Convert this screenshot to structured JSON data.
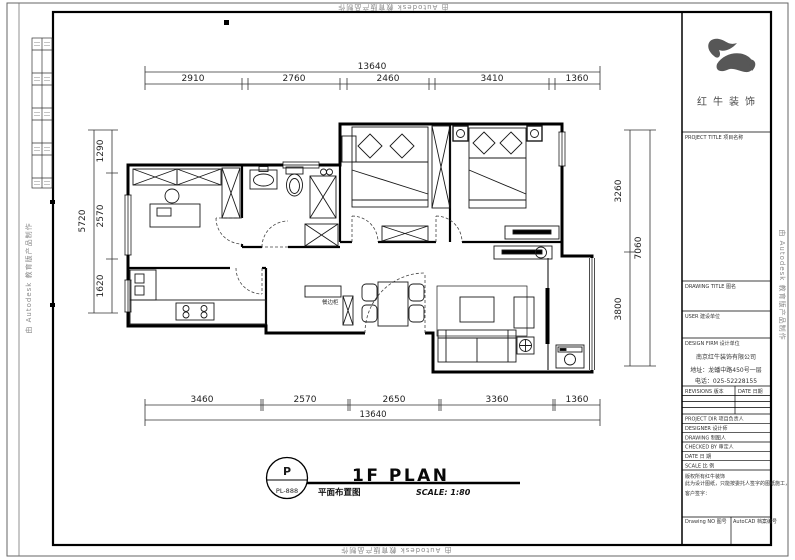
{
  "watermark": "由 Autodesk 教育版产品制作",
  "brand": {
    "name_cn": "红牛装饰"
  },
  "title_block": {
    "project_title": "PROJECT TITLE 项目名称",
    "drawing_title": "DRAWING TITLE 图名",
    "user": "USER 建设单位",
    "design_firm": "DESIGN FIRM 设计单位",
    "company_name": "南京红牛装饰有限公司",
    "address": "地址：龙蟠中路450号一层",
    "phone": "电话：025-52228155",
    "revisions": "REVISIONS 版本",
    "date_col": "DATE 日期",
    "row_labels": [
      "PROJECT DIR 项目负责人",
      "DESIGNER 设计师",
      "DRAWING 制图人",
      "CHECKED BY 审定人",
      "DATE 日 期",
      "SCALE 比 例"
    ],
    "note_line1": "版权所有红牛装饰",
    "note_line2": "此为设计图纸，只能按委托人签字的图纸施工，",
    "client_sign": "客户签字：",
    "drawing_no": "Drawing NO 图号",
    "file_no": "AutoCAD 档案编号"
  },
  "plan": {
    "sheet_mark_top": "P",
    "sheet_mark_bottom": "PL-888",
    "title_en": "1F PLAN",
    "title_cn": "平面布置图",
    "scale": "SCALE: 1:80",
    "furniture_label": "餐边柜",
    "dims": {
      "top_total": "13640",
      "top": [
        "2910",
        "2760",
        "2460",
        "3410",
        "1360"
      ],
      "bottom": [
        "3460",
        "2570",
        "2650",
        "3360",
        "1360"
      ],
      "bottom_total": "13640",
      "left": [
        "1290",
        "2570",
        "1620"
      ],
      "left_total": "5720",
      "right": [
        "3260",
        "3800"
      ],
      "right_total": "7060"
    }
  }
}
